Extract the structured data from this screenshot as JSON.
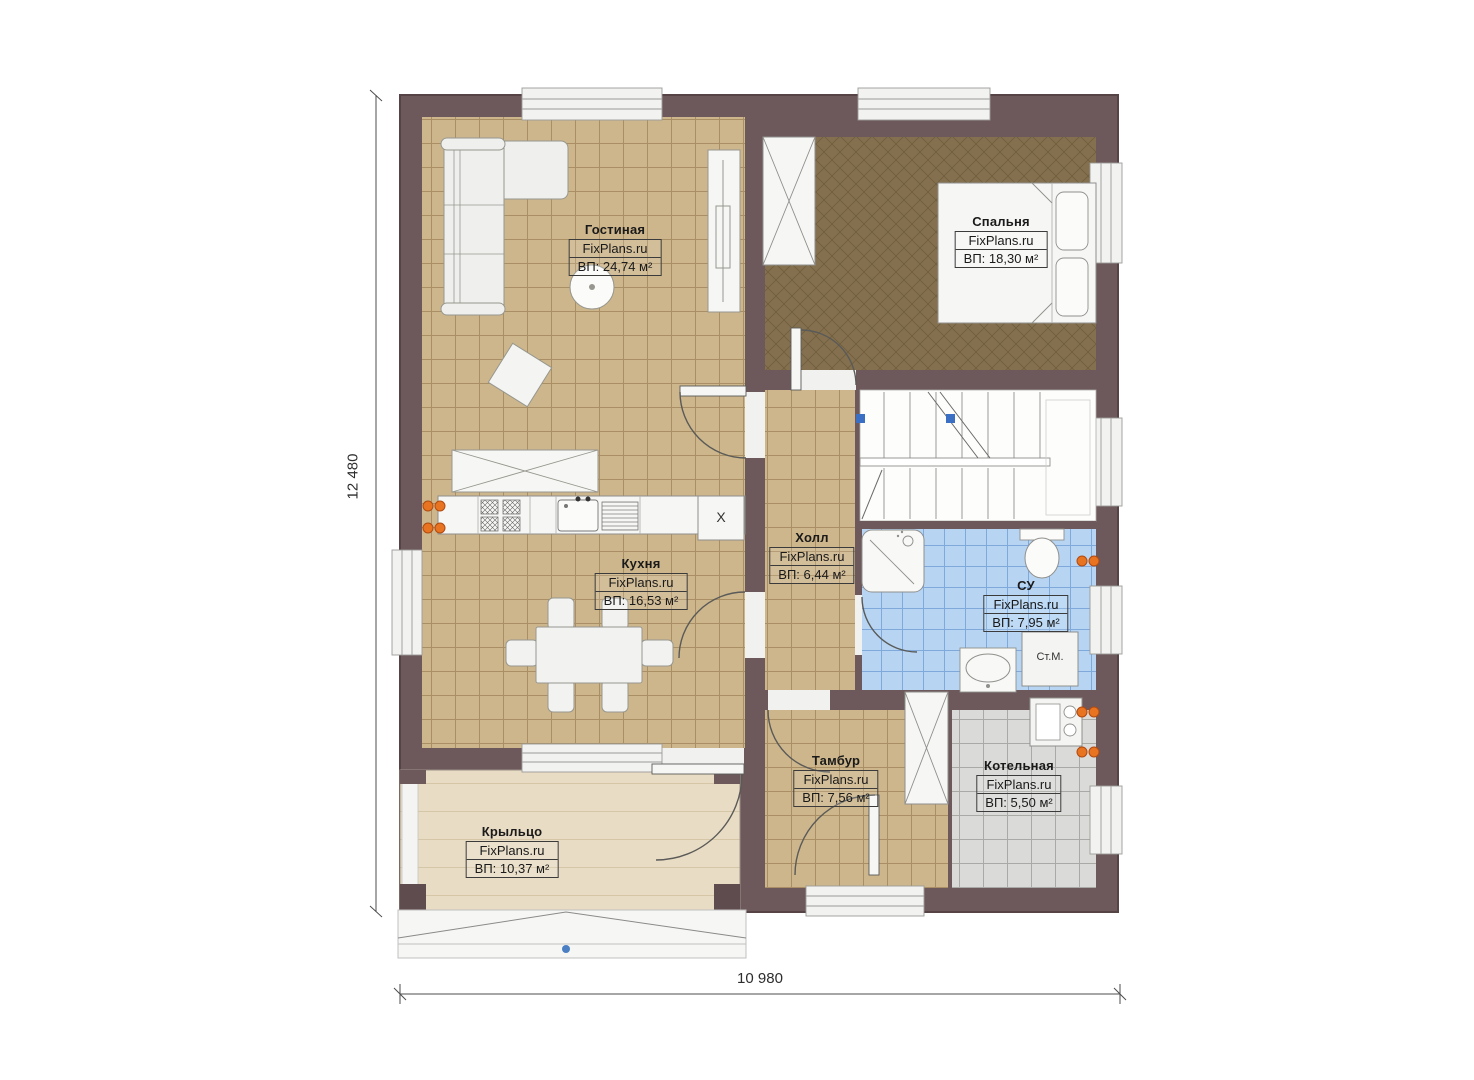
{
  "plan": {
    "brand": "FixPlans.ru",
    "dimensions": {
      "height": "12 480",
      "width": "10 980"
    }
  },
  "rooms": [
    {
      "name": "Гостиная",
      "brand": "FixPlans.ru",
      "area": "ВП: 24,74 м²"
    },
    {
      "name": "Спальня",
      "brand": "FixPlans.ru",
      "area": "ВП: 18,30 м²"
    },
    {
      "name": "Кухня",
      "brand": "FixPlans.ru",
      "area": "ВП: 16,53 м²"
    },
    {
      "name": "Холл",
      "brand": "FixPlans.ru",
      "area": "ВП: 6,44 м²"
    },
    {
      "name": "СУ",
      "brand": "FixPlans.ru",
      "area": "ВП: 7,95 м²"
    },
    {
      "name": "Тамбур",
      "brand": "FixPlans.ru",
      "area": "ВП: 7,56 м²"
    },
    {
      "name": "Котельная",
      "brand": "FixPlans.ru",
      "area": "ВП: 5,50 м²"
    },
    {
      "name": "Крыльцо",
      "brand": "FixPlans.ru",
      "area": "ВП: 10,37 м²"
    }
  ],
  "annotations": {
    "washing_machine": "Ст.М.",
    "kitchen_unit_mark": "X"
  },
  "colors": {
    "wall": "#6d595b",
    "wall_outline": "#554346",
    "floor_tan": "#cdb68c",
    "floor_bedroom": "#84704e",
    "floor_bath": "#b7d5f3",
    "floor_boiler": "#dadad8",
    "floor_porch": "#e9dcc4",
    "radiator": "#e87320",
    "marker_blue": "#4a7fc4"
  }
}
